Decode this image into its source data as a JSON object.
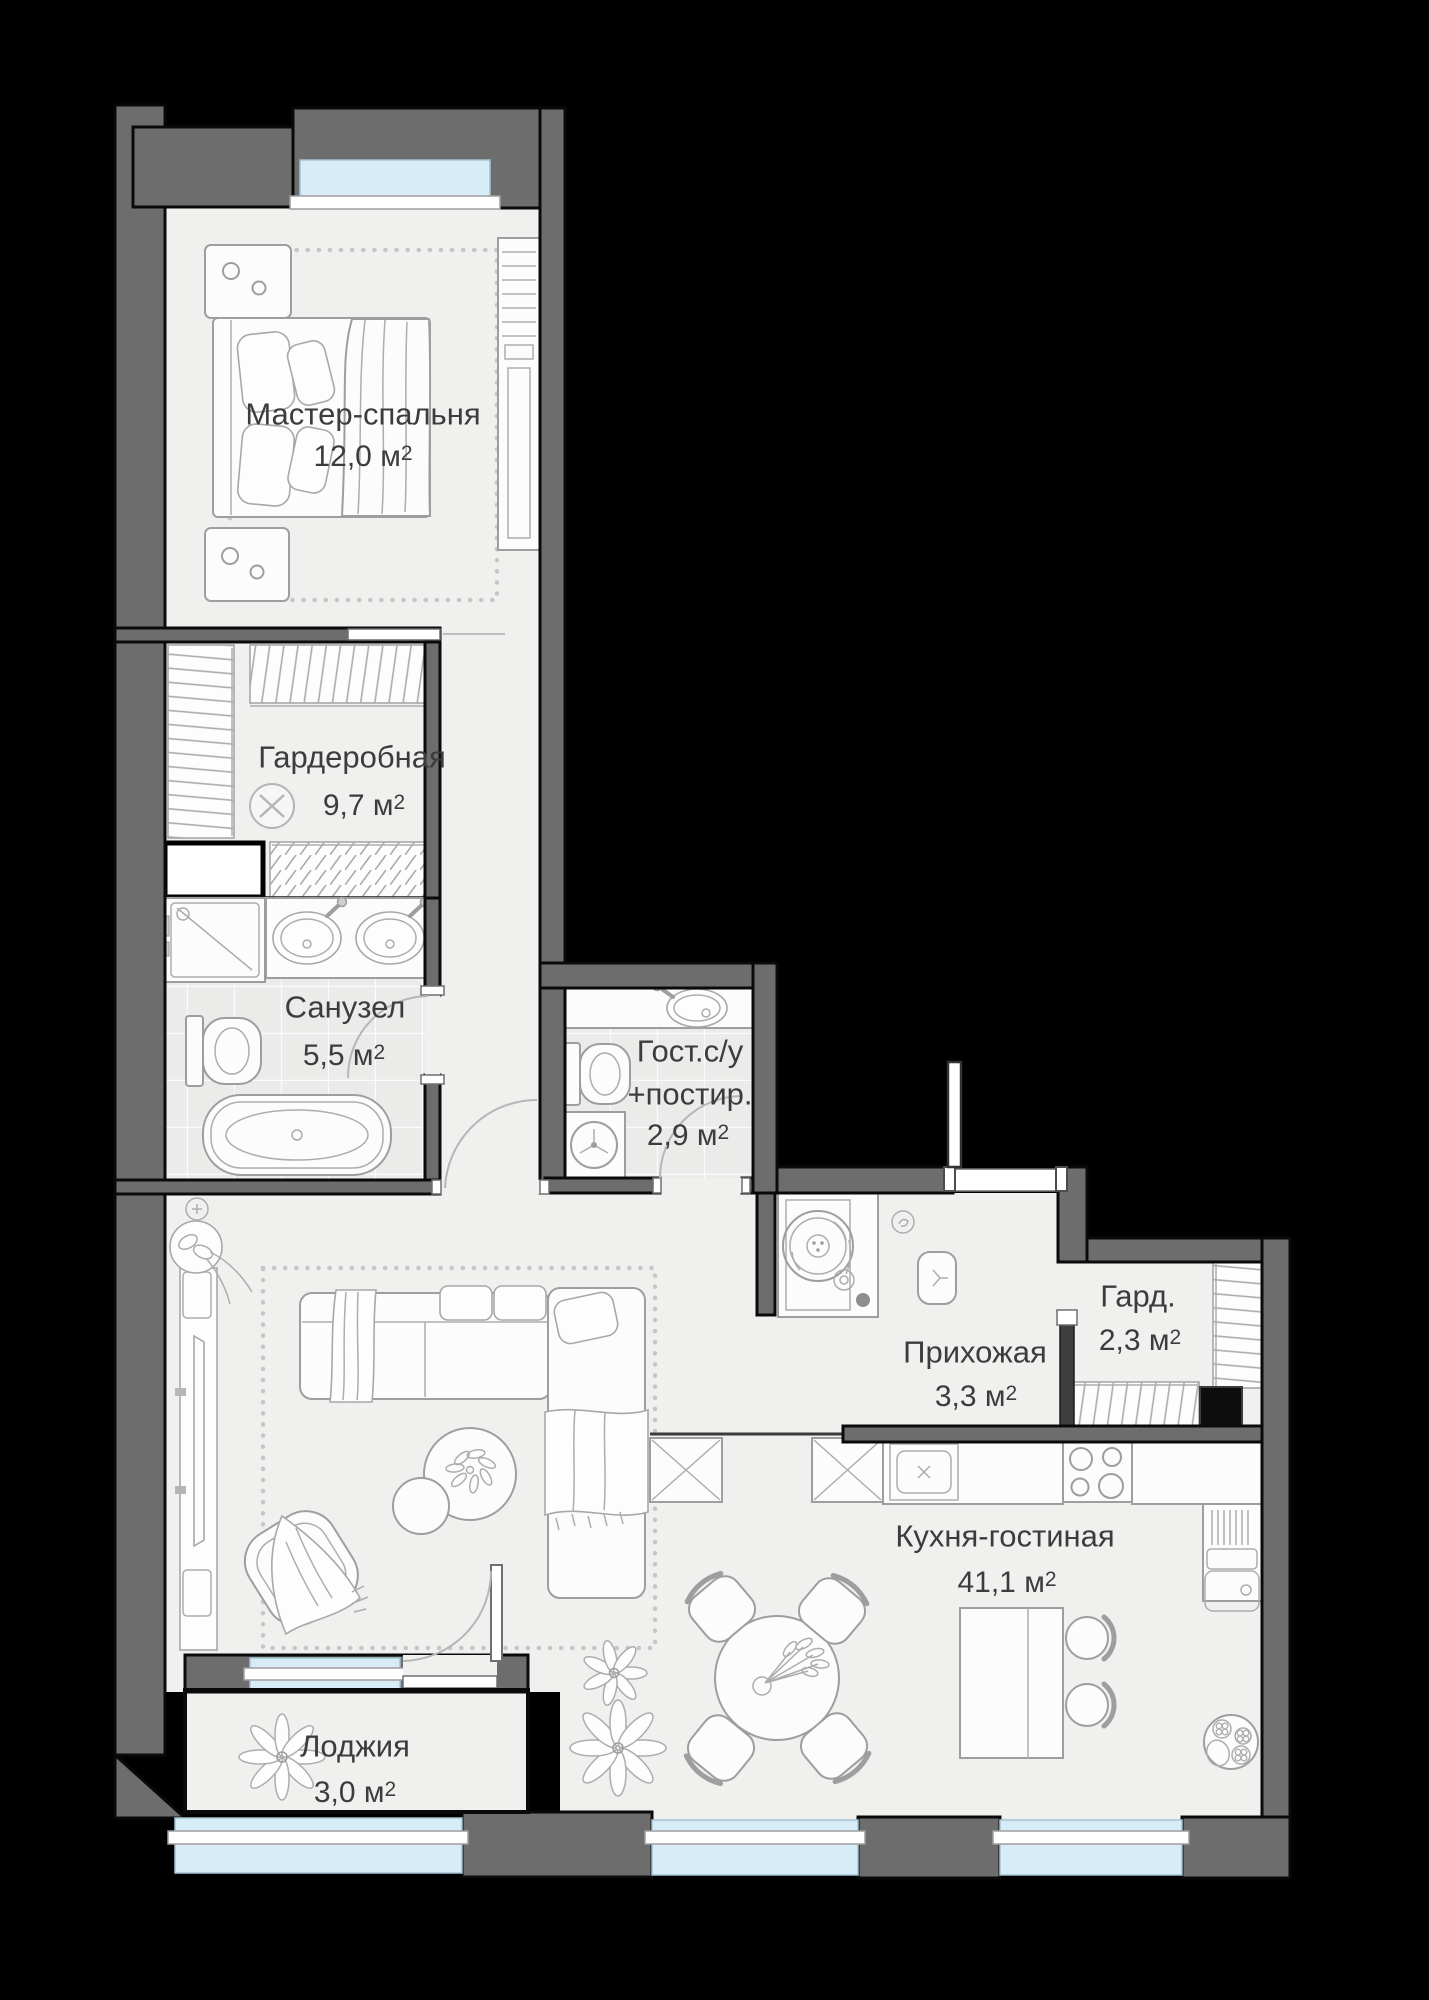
{
  "palette": {
    "background": "#000000",
    "wall": "#6d6d6d",
    "wall_outline": "#0a0a0a",
    "floor": "#f0f0ee",
    "tile_floor": "#ebebea",
    "window_glass": "#d8ecf7",
    "furniture_line": "#9e9e9e",
    "label_text": "#3c3c3c"
  },
  "rooms": [
    {
      "id": "master-bedroom",
      "name": "Мастер-спальня",
      "area": "12,0 м",
      "sup": "2"
    },
    {
      "id": "wardrobe",
      "name": "Гардеробная",
      "area": "9,7 м",
      "sup": "2"
    },
    {
      "id": "bathroom",
      "name": "Санузел",
      "area": "5,5 м",
      "sup": "2"
    },
    {
      "id": "guest-wc-laundry",
      "name": "Гост.с/у",
      "name_line2": "+постир.",
      "area": "2,9 м",
      "sup": "2"
    },
    {
      "id": "hallway",
      "name": "Прихожая",
      "area": "3,3 м",
      "sup": "2"
    },
    {
      "id": "closet",
      "name": "Гард.",
      "area": "2,3 м",
      "sup": "2"
    },
    {
      "id": "kitchen-living",
      "name": "Кухня-гостиная",
      "area": "41,1 м",
      "sup": "2"
    },
    {
      "id": "loggia",
      "name": "Лоджия",
      "area": "3,0 м",
      "sup": "2"
    }
  ],
  "legend_furniture": [
    "double-bed",
    "nightstand",
    "wardrobe-shelves",
    "clothes-rail",
    "extractor-fan",
    "ventilation-shaft",
    "shower",
    "double-washbasin",
    "toilet",
    "bathtub",
    "washbasin",
    "washing-machine",
    "entrance-door",
    "record-player-console",
    "bench",
    "coat-hook",
    "kitchen-tall-cabinet",
    "hob",
    "kitchen-sink",
    "dish-rack",
    "kitchen-island",
    "bar-stool",
    "dining-table",
    "dining-chair",
    "sofa",
    "chaise",
    "armchair",
    "coffee-table",
    "tv-console",
    "plant",
    "window",
    "loggia-window"
  ]
}
